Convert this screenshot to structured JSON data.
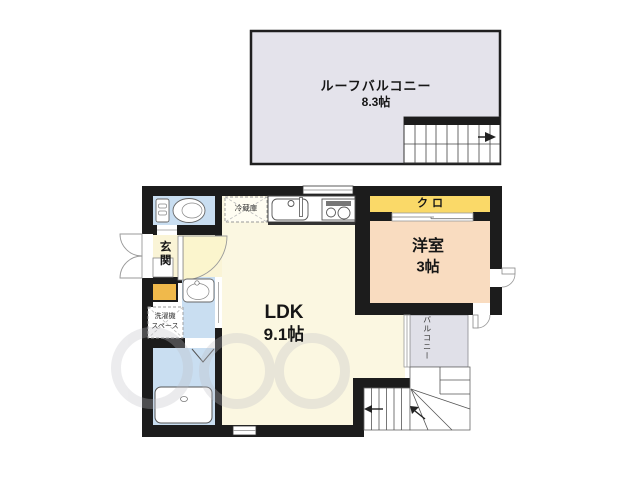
{
  "rooms": {
    "roof_balcony": {
      "name": "ルーフバルコニー",
      "size": "8.3帖"
    },
    "ldk": {
      "name": "LDK",
      "size": "9.1帖"
    },
    "western_room": {
      "name": "洋室",
      "size": "3帖"
    },
    "closet": {
      "name": "クロ"
    },
    "entrance": {
      "name": "玄関"
    },
    "balcony": {
      "name": "バルコニー"
    }
  },
  "fixtures": {
    "refrigerator": "冷蔵庫",
    "washer_line1": "洗濯機",
    "washer_line2": "スペース"
  },
  "colors": {
    "wall": "#1c1c1c",
    "roof_balcony": "#e4e3eb",
    "ldk": "#fbf7e1",
    "entrance_hall": "#faf4d6",
    "door_swing": "#fbf5cd",
    "water_rooms": "#c9def1",
    "western_room": "#f9dcc0",
    "closet": "#fad968",
    "step": "#f0b94b",
    "balcony_strip": "#e0e0e8"
  }
}
